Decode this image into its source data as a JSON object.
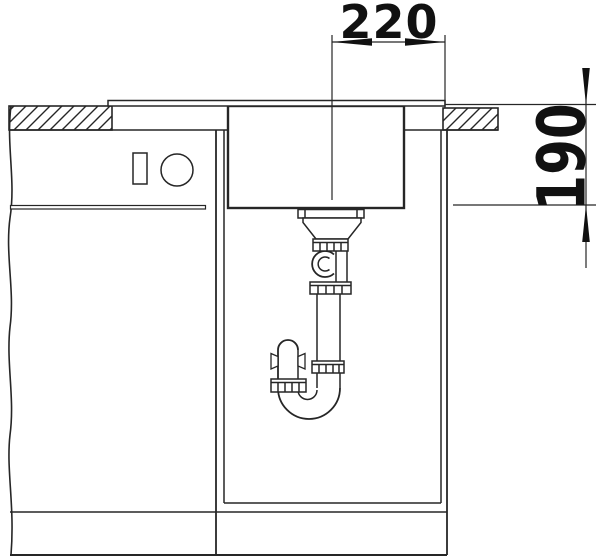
{
  "diagram": {
    "dimensions": {
      "width": {
        "value": "220"
      },
      "depth": {
        "value": "190"
      }
    },
    "colors": {
      "line": "#262626",
      "text": "#111111",
      "background": "#ffffff"
    }
  }
}
